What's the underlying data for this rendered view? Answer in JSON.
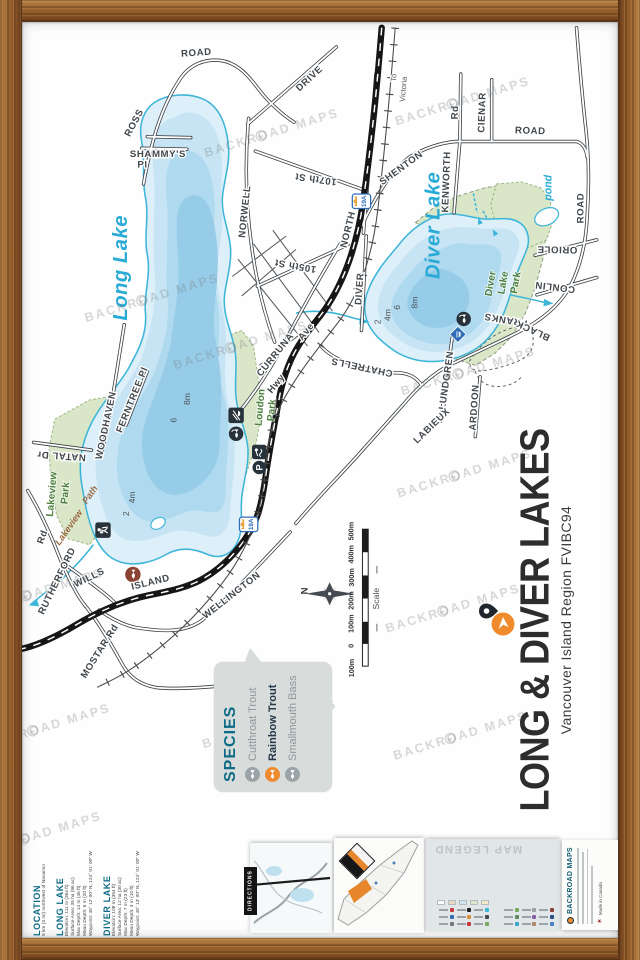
{
  "title_block": {
    "title": "LONG & DIVER LAKES",
    "subtitle": "Vancouver Island Region FVIBC94"
  },
  "species_box": {
    "heading": "SPECIES",
    "items": [
      {
        "name": "Cutthroat Trout",
        "highlight": false
      },
      {
        "name": "Rainbow Trout",
        "highlight": true
      },
      {
        "name": "Smallmouth Bass",
        "highlight": false
      }
    ],
    "highlight_color": "#ee8a2f"
  },
  "info_block": {
    "location": {
      "heading": "LOCATION",
      "line": "5 km (3 mi) northwest of Nanaimo"
    },
    "long_lake": {
      "heading": "LONG LAKE",
      "lines": [
        "Elevation: 111 m (364 ft)",
        "Surface Area: 39 ha (96 ac)",
        "Max Depth: 14 m (46 ft)",
        "Mean Depth: 6 m (20 ft)",
        "Waypoint: 49° 12' 00\" N, 124° 01' 00\" W"
      ]
    },
    "diver_lake": {
      "heading": "DIVER LAKE",
      "lines": [
        "Elevation: 108 m (354 ft)",
        "Surface Area: 12 ha (30 ac)",
        "Max Depth: 7 m (23 ft)",
        "Mean Depth: 3 m (10 ft)",
        "Waypoint: 49° 13' 00\" N, 124° 01' 00\" W"
      ]
    }
  },
  "scale": {
    "caption": "Scale",
    "labels": [
      "100m",
      "0",
      "100m",
      "200m",
      "300m",
      "400m",
      "500m"
    ],
    "label_ys": [
      684,
      661,
      638,
      614,
      590,
      566,
      542
    ]
  },
  "compass": {
    "north": "N"
  },
  "watermark": {
    "text": "BACKROAD MAPS",
    "positions": [
      {
        "x": 158,
        "y": 306
      },
      {
        "x": 480,
        "y": 102
      },
      {
        "x": 282,
        "y": 135
      },
      {
        "x": 250,
        "y": 355
      },
      {
        "x": 482,
        "y": 488
      },
      {
        "x": 470,
        "y": 628
      },
      {
        "x": 478,
        "y": 760
      },
      {
        "x": 38,
        "y": 612
      },
      {
        "x": 280,
        "y": 748
      },
      {
        "x": 36,
        "y": 864
      },
      {
        "x": 486,
        "y": 382
      },
      {
        "x": 45,
        "y": 752
      }
    ]
  },
  "map": {
    "accent_colors": {
      "water": "#3db5d9",
      "hwy_shield": "#2f6db8",
      "park_green": "#d9e7c8"
    },
    "shields": [
      {
        "label": "19A",
        "x": 374,
        "y": 202
      },
      {
        "label": "19A",
        "x": 257,
        "y": 537
      }
    ],
    "labels": [
      {
        "t": "ROAD",
        "x": 203,
        "y": 51,
        "r": -4,
        "c": "road"
      },
      {
        "t": "ROSS",
        "x": 141,
        "y": 122,
        "r": -62,
        "c": "road"
      },
      {
        "t": "SHAMMY'S",
        "x": 163,
        "y": 156,
        "r": 0,
        "c": "road",
        "s": 9
      },
      {
        "t": "Pl",
        "x": 147,
        "y": 167,
        "r": 0,
        "c": "road",
        "s": 9
      },
      {
        "t": "DRIVE",
        "x": 322,
        "y": 77,
        "r": -43,
        "c": "road"
      },
      {
        "t": "NORWELL",
        "x": 256,
        "y": 213,
        "r": -84,
        "c": "road"
      },
      {
        "t": "107th St",
        "x": 327,
        "y": 176,
        "r": 188,
        "c": "road",
        "s": 9.5
      },
      {
        "t": "105th St",
        "x": 306,
        "y": 266,
        "r": 190,
        "c": "road",
        "s": 9.5
      },
      {
        "t": "NORTH",
        "x": 363,
        "y": 232,
        "r": -76,
        "c": "road"
      },
      {
        "t": "SHENTON",
        "x": 417,
        "y": 170,
        "r": -36,
        "c": "road"
      },
      {
        "t": "Rd",
        "x": 474,
        "y": 110,
        "r": -88,
        "c": "road",
        "s": 9
      },
      {
        "t": "KENWORTH",
        "x": 465,
        "y": 182,
        "r": -88,
        "c": "road"
      },
      {
        "t": "CIENAR",
        "x": 502,
        "y": 110,
        "r": -88,
        "c": "road"
      },
      {
        "t": "ROAD",
        "x": 549,
        "y": 132,
        "r": 2,
        "c": "road"
      },
      {
        "t": "ROAD",
        "x": 604,
        "y": 209,
        "r": -90,
        "c": "road"
      },
      {
        "t": "ORIOLE",
        "x": 577,
        "y": 249,
        "r": 181,
        "c": "road"
      },
      {
        "t": "CONLIN",
        "x": 575,
        "y": 288,
        "r": 187,
        "c": "road"
      },
      {
        "t": "FRANKS",
        "x": 524,
        "y": 322,
        "r": 190,
        "c": "road"
      },
      {
        "t": "BLACK",
        "x": 553,
        "y": 333,
        "r": 205,
        "c": "road"
      },
      {
        "t": "LUNDGREN",
        "x": 465,
        "y": 388,
        "r": -82,
        "c": "road"
      },
      {
        "t": "ARDOON",
        "x": 494,
        "y": 416,
        "r": -86,
        "c": "road"
      },
      {
        "t": "LABIEUX",
        "x": 449,
        "y": 437,
        "r": -44,
        "c": "road"
      },
      {
        "t": "CHATRELLS",
        "x": 375,
        "y": 371,
        "r": 192,
        "c": "road"
      },
      {
        "t": "CURRUNA",
        "x": 287,
        "y": 363,
        "r": -51,
        "c": "road"
      },
      {
        "t": "Ave",
        "x": 319,
        "y": 339,
        "r": -51,
        "c": "road",
        "s": 9
      },
      {
        "t": "Hwy",
        "x": 288,
        "y": 393,
        "r": -51,
        "c": "road",
        "s": 9
      },
      {
        "t": "DIVER",
        "x": 375,
        "y": 293,
        "r": -86,
        "c": "road"
      },
      {
        "t": "ISLAND",
        "x": 156,
        "y": 600,
        "r": -14,
        "c": "road"
      },
      {
        "t": "WELLINGTON",
        "x": 241,
        "y": 613,
        "r": -38,
        "c": "road"
      },
      {
        "t": "WILLS",
        "x": 93,
        "y": 595,
        "r": -26,
        "c": "road"
      },
      {
        "t": "RUTHERFORD",
        "x": 61,
        "y": 597,
        "r": -64,
        "c": "road"
      },
      {
        "t": "Rd",
        "x": 46,
        "y": 551,
        "r": -70,
        "c": "road",
        "s": 9
      },
      {
        "t": "MOSTAR Rd",
        "x": 105,
        "y": 670,
        "r": -58,
        "c": "road"
      },
      {
        "t": "NATAL Dr",
        "x": 63,
        "y": 463,
        "r": 184,
        "c": "road",
        "s": 9
      },
      {
        "t": "WOODHAVEN",
        "x": 112,
        "y": 435,
        "r": -78,
        "c": "road"
      },
      {
        "t": "FERNTREE Pl",
        "x": 139,
        "y": 409,
        "r": -68,
        "c": "road",
        "s": 9
      },
      {
        "t": "To",
        "x": 410,
        "y": 74,
        "r": -85,
        "c": "small"
      },
      {
        "t": "Victoria",
        "x": 420,
        "y": 86,
        "r": -85,
        "c": "small"
      },
      {
        "t": "Long Lake",
        "x": 131,
        "y": 271,
        "r": -90,
        "c": "lake"
      },
      {
        "t": "Diver Lake",
        "x": 455,
        "y": 227,
        "r": -90,
        "c": "lake"
      },
      {
        "t": "Lakeview",
        "x": 56,
        "y": 506,
        "r": -85,
        "c": "park"
      },
      {
        "t": "Park",
        "x": 70,
        "y": 505,
        "r": -85,
        "c": "park"
      },
      {
        "t": "Loudon",
        "x": 272,
        "y": 416,
        "r": -85,
        "c": "park"
      },
      {
        "t": "Park",
        "x": 284,
        "y": 419,
        "r": -85,
        "c": "park"
      },
      {
        "t": "Diver",
        "x": 511,
        "y": 288,
        "r": -80,
        "c": "park"
      },
      {
        "t": "Lake",
        "x": 524,
        "y": 287,
        "r": -80,
        "c": "park"
      },
      {
        "t": "Park",
        "x": 537,
        "y": 287,
        "r": -80,
        "c": "park"
      },
      {
        "t": "Lakeview",
        "x": 73,
        "y": 542,
        "r": -55,
        "c": "path"
      },
      {
        "t": "Path",
        "x": 95,
        "y": 508,
        "r": -55,
        "c": "path"
      },
      {
        "t": "2",
        "x": 133,
        "y": 526,
        "r": -90,
        "c": "depth"
      },
      {
        "t": "4m",
        "x": 139,
        "y": 509,
        "r": -90,
        "c": "depth"
      },
      {
        "t": "6",
        "x": 182,
        "y": 429,
        "r": -90,
        "c": "depth"
      },
      {
        "t": "8m",
        "x": 196,
        "y": 407,
        "r": -90,
        "c": "depth"
      },
      {
        "t": "2",
        "x": 394,
        "y": 327,
        "r": -90,
        "c": "depth"
      },
      {
        "t": "4m",
        "x": 404,
        "y": 320,
        "r": -90,
        "c": "depth"
      },
      {
        "t": "6",
        "x": 414,
        "y": 312,
        "r": -90,
        "c": "depth"
      },
      {
        "t": "8m",
        "x": 432,
        "y": 307,
        "r": -90,
        "c": "depth"
      },
      {
        "t": "pond",
        "x": 571,
        "y": 188,
        "r": -90,
        "c": "pondlbl"
      },
      {
        "t": "N",
        "x": 318,
        "y": 606,
        "r": -90,
        "c": "compassN"
      }
    ]
  },
  "montage": {
    "directions_label": "DIRECTIONS",
    "legend_title": "MAP LEGEND",
    "brand_name": "BACKROAD MAPS",
    "made_in": "Made in Canada",
    "legend_colors": [
      "#4a7fc1",
      "#7aa85c",
      "#b08968",
      "#c23b3b",
      "#3aa6c9",
      "#777777",
      "#2b4a8b",
      "#4a4a4a",
      "#8a5fa8",
      "#d98f3d",
      "#5b8c5a",
      "#2f6db8",
      "#8a4232",
      "#3db5d9",
      "#9aa4a6",
      "#1c1c1c",
      "#7aa85c",
      "#c23b3b"
    ],
    "legend_chips": [
      "#f3e9c8",
      "#d9e6c9",
      "#cfe3f0",
      "#e8d9c6",
      "#ffffff"
    ]
  }
}
